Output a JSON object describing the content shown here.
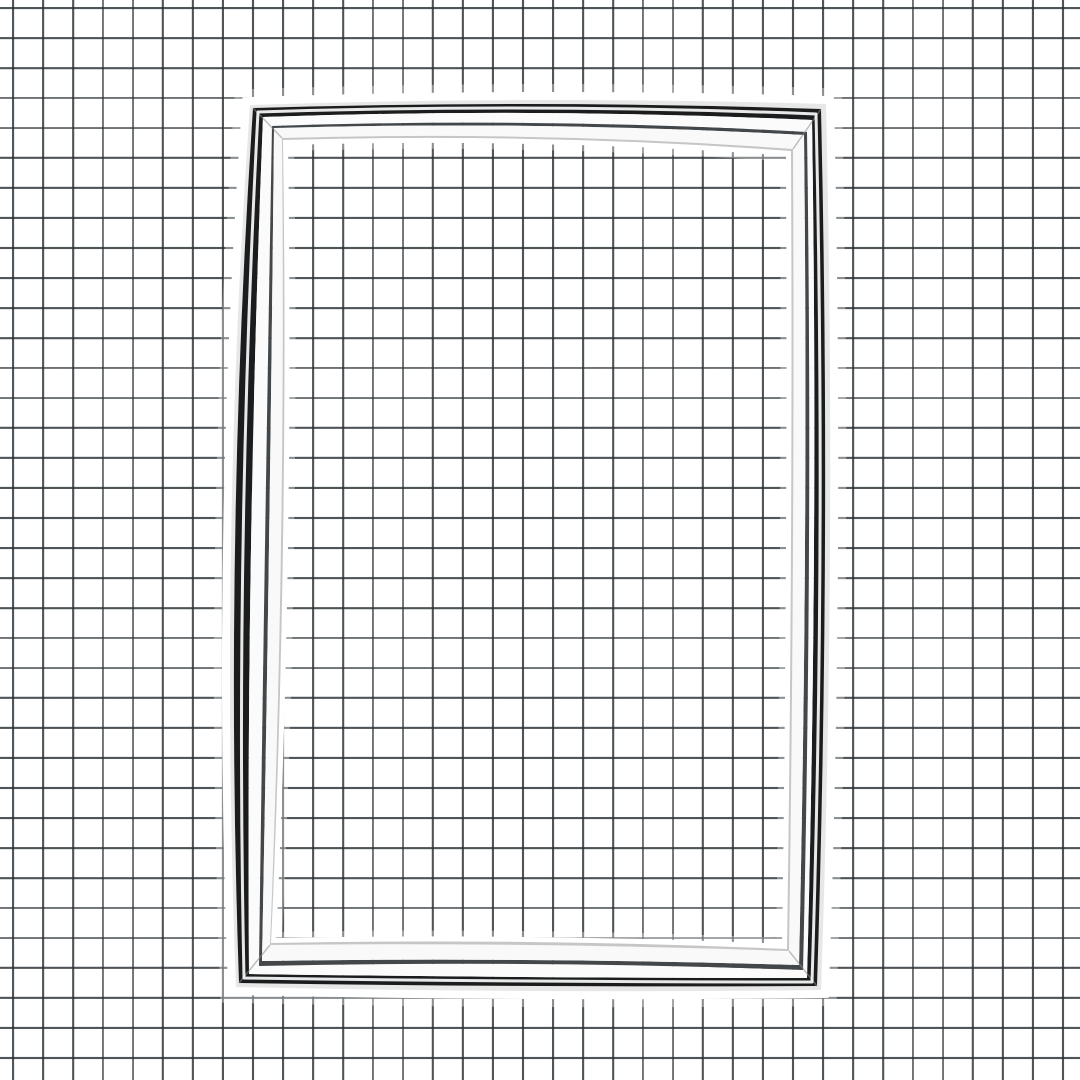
{
  "meta": {
    "description": "Product photograph of a rectangular refrigerator door gasket seal (black and chrome-white molded frame) lying on white graph paper",
    "visible_text": ""
  },
  "canvas": {
    "width": 1080,
    "height": 1080
  },
  "paper": {
    "color": "#ffffff",
    "grid_line_color": "#272e32",
    "grid_line_opacity": 0.82,
    "cell_size": 30,
    "line_width": 2,
    "offset_x": 12,
    "offset_y": 7
  },
  "gasket": {
    "halo_color": "#ffffff",
    "halo": {
      "outer_solid_width": 16,
      "outer_soft_width": 32,
      "outer_soft_opacity": 0.35,
      "inner_solid_width": 10,
      "inner_soft_width": 22,
      "inner_soft_opacity": 0.35
    },
    "miter_line_color": "#8d8d8d",
    "miter_line_width": 1.5,
    "miter_line_opacity": 0.55,
    "highlight_color": "#ffffff",
    "highlight_width": 3,
    "highlight_opacity": 0.9,
    "rings": [
      {
        "name": "outer-lip",
        "fill": "#e7e7e7",
        "outer": "b0",
        "inner": "b1"
      },
      {
        "name": "outer-dark-band",
        "fill": "#1a1c1d",
        "outer": "b1",
        "inner": "b2"
      },
      {
        "name": "outer-white-band",
        "fill": "#fbfbfb",
        "outer": "b2",
        "inner": "b3"
      },
      {
        "name": "pinstripe",
        "fill": "#43474a",
        "outer": "b3",
        "inner": "b4"
      },
      {
        "name": "inner-white-band",
        "fill": "#f9f9f9",
        "outer": "b4",
        "inner": "b5"
      },
      {
        "name": "inner-lip",
        "fill": "#c6c6c6",
        "outer": "b5",
        "inner": "b6"
      }
    ],
    "boundaries": {
      "b0": {
        "tl": [
          250,
          105
        ],
        "tr": [
          826,
          104
        ],
        "br": [
          821,
          990
        ],
        "bl": [
          236,
          987
        ],
        "mid_top": [
          538,
          100
        ],
        "mid_right": [
          830,
          546
        ],
        "mid_bottom": [
          529,
          991
        ],
        "mid_left": [
          231,
          546
        ]
      },
      "b1": {
        "tl": [
          253,
          108
        ],
        "tr": [
          821,
          109
        ],
        "br": [
          817,
          986
        ],
        "bl": [
          239,
          983
        ],
        "mid_top": [
          538,
          104
        ],
        "mid_right": [
          825,
          546
        ],
        "mid_bottom": [
          529,
          986
        ],
        "mid_left": [
          235,
          546
        ]
      },
      "b2": {
        "tl": [
          263,
          117
        ],
        "tr": [
          812,
          120
        ],
        "br": [
          807,
          978
        ],
        "bl": [
          249,
          974
        ],
        "mid_top": [
          538,
          113
        ],
        "mid_right": [
          814,
          546
        ],
        "mid_bottom": [
          529,
          977
        ],
        "mid_left": [
          251,
          546
        ]
      },
      "b3": {
        "tl": [
          272,
          126
        ],
        "tr": [
          807,
          132
        ],
        "br": [
          803,
          970
        ],
        "bl": [
          259,
          966
        ],
        "mid_top": [
          538,
          123
        ],
        "mid_right": [
          809,
          546
        ],
        "mid_bottom": [
          529,
          964
        ],
        "mid_left": [
          265,
          546
        ]
      },
      "b4": {
        "tl": [
          274,
          128
        ],
        "tr": [
          804,
          135
        ],
        "br": [
          799,
          965
        ],
        "bl": [
          262,
          961
        ],
        "mid_top": [
          538,
          126
        ],
        "mid_right": [
          805,
          546
        ],
        "mid_bottom": [
          529,
          960
        ],
        "mid_left": [
          269,
          546
        ]
      },
      "b5": {
        "tl": [
          282,
          138
        ],
        "tr": [
          793,
          149
        ],
        "br": [
          789,
          951
        ],
        "bl": [
          270,
          945
        ],
        "mid_top": [
          538,
          137
        ],
        "mid_right": [
          793,
          546
        ],
        "mid_bottom": [
          529,
          945
        ],
        "mid_left": [
          281,
          546
        ]
      },
      "b6": {
        "tl": [
          283,
          140
        ],
        "tr": [
          791,
          151
        ],
        "br": [
          787,
          949
        ],
        "bl": [
          271,
          943
        ],
        "mid_top": [
          538,
          139
        ],
        "mid_right": [
          791,
          546
        ],
        "mid_bottom": [
          529,
          942
        ],
        "mid_left": [
          283,
          546
        ]
      }
    },
    "highlight_path": {
      "tl": [
        258,
        112
      ],
      "tr": [
        816,
        114
      ],
      "br": [
        812,
        982
      ],
      "bl": [
        244,
        978
      ],
      "mid_top": [
        538,
        108
      ],
      "mid_right": [
        820,
        546
      ],
      "mid_bottom": [
        529,
        981
      ],
      "mid_left": [
        243,
        546
      ]
    }
  }
}
